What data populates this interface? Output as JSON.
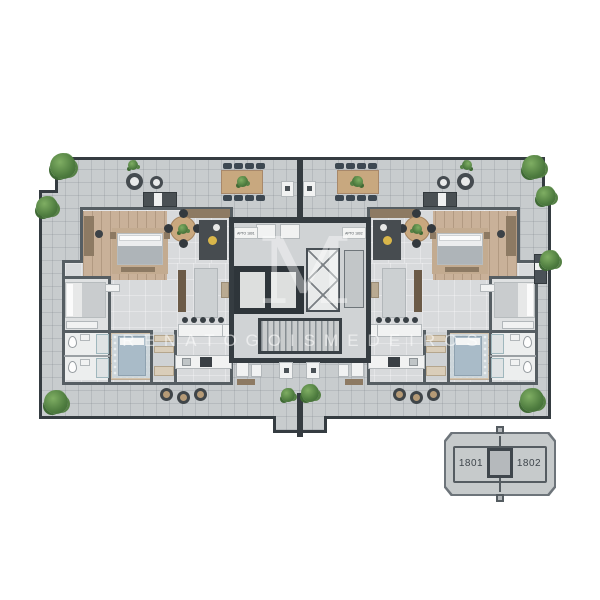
{
  "page": {
    "type": "apartment-floor-plan-rendering",
    "background": "#ffffff"
  },
  "watermark": {
    "monogram": "M",
    "name": "RENATOGOISMEDEIROS"
  },
  "core": {
    "left_unit_tag": "APTO 1801",
    "right_unit_tag": "APTO 1802"
  },
  "keyplan": {
    "left_unit": "1801",
    "right_unit": "1802"
  },
  "palette": {
    "terrace": "#c8ccce",
    "interior_floor": "#d8dadc",
    "wood_floor": "#c9b199",
    "wall": "#565e63",
    "core_wall": "#353c41",
    "plant_green": "#4e7c3f",
    "accent_yellow": "#d9b64a",
    "bed_blue": "#a9bbc8",
    "keyplan_fill": "#c6cacb"
  }
}
